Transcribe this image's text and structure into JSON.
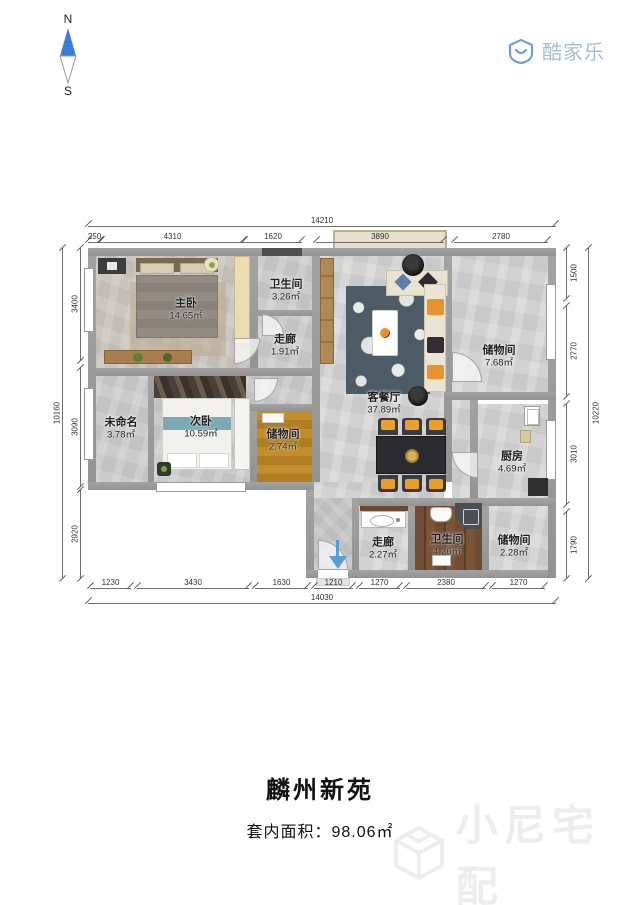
{
  "compass": {
    "north": "N",
    "south": "S"
  },
  "brand": {
    "name": "酷家乐"
  },
  "plan": {
    "rooms": [
      {
        "name": "主卧",
        "area": "14.65㎡"
      },
      {
        "name": "卫生间",
        "area": "3.26㎡"
      },
      {
        "name": "走廊",
        "area": "1.91㎡"
      },
      {
        "name": "客餐厅",
        "area": "37.89㎡"
      },
      {
        "name": "储物间",
        "area": "7.68㎡"
      },
      {
        "name": "未命名",
        "area": "3.78㎡"
      },
      {
        "name": "次卧",
        "area": "10.59㎡"
      },
      {
        "name": "储物间",
        "area": "2.74㎡"
      },
      {
        "name": "厨房",
        "area": "4.69㎡"
      },
      {
        "name": "走廊",
        "area": "2.27㎡"
      },
      {
        "name": "卫生间",
        "area": "4.26㎡"
      },
      {
        "name": "储物间",
        "area": "2.28㎡"
      }
    ],
    "dimensions": {
      "top": {
        "total": "14210",
        "segments": [
          "250",
          "4310",
          "1620",
          "3890",
          "2780"
        ]
      },
      "bottom": {
        "total": "14030",
        "segments": [
          "1230",
          "3430",
          "1630",
          "1210",
          "1270",
          "2380",
          "1270"
        ]
      },
      "left": {
        "total": "10160",
        "segments": [
          "3400",
          "3090",
          "2920"
        ]
      },
      "right": {
        "total": "10220",
        "segments": [
          "1500",
          "2770",
          "3010",
          "1790"
        ]
      }
    }
  },
  "footer": {
    "title": "麟州新苑",
    "area_label": "套内面积：",
    "area_value": "98.06㎡"
  },
  "watermark": {
    "text": "小尼宅配"
  },
  "colors": {
    "accent_blue": "#3b7dd8",
    "wall_gray": "#9a9a9a",
    "sofa_orange": "#e8932a",
    "amber_floor": "#bc8526"
  }
}
